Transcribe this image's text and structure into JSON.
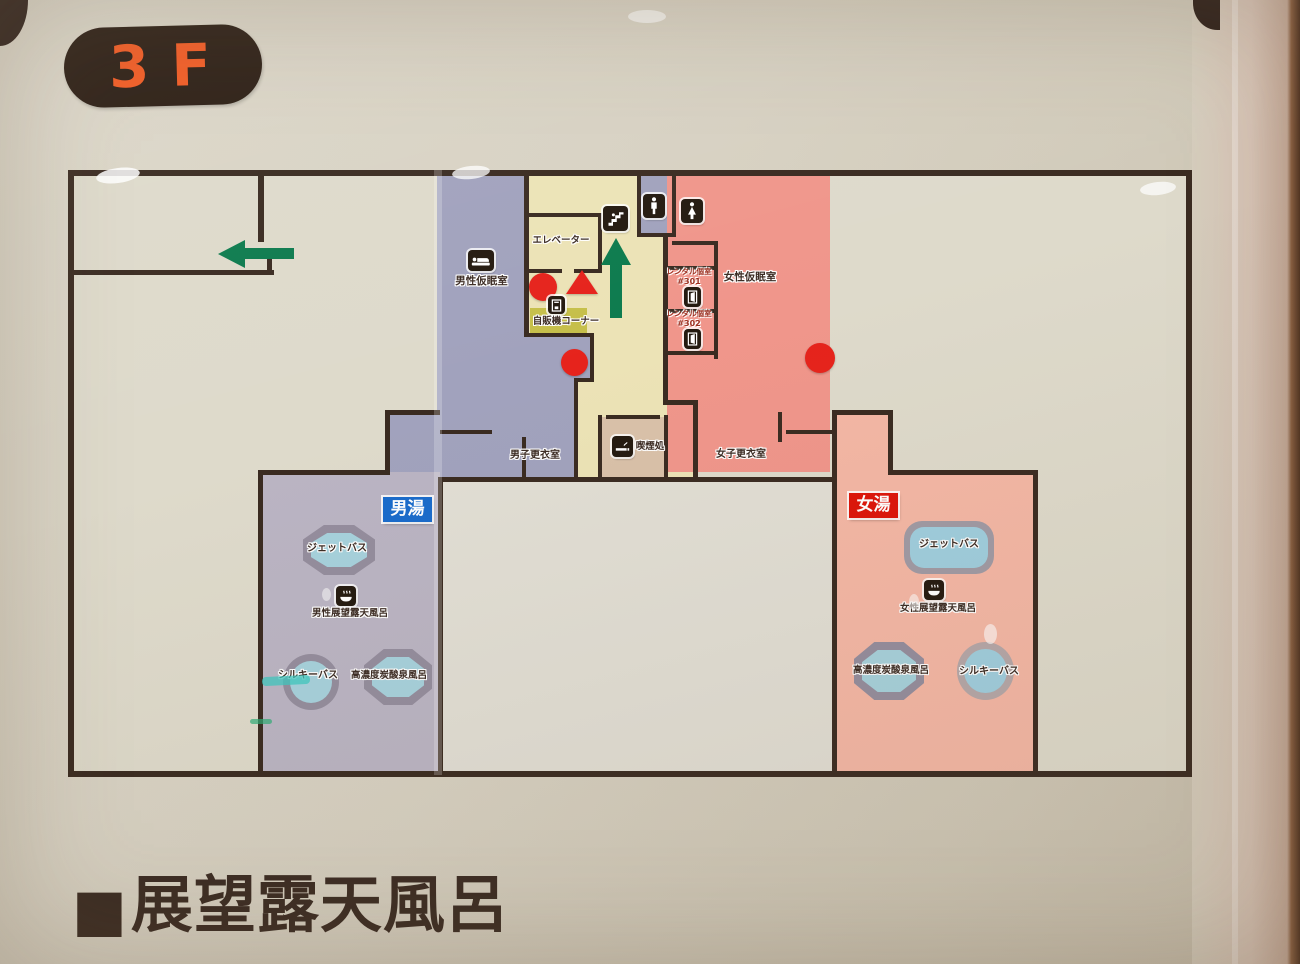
{
  "floor_badge": {
    "label": "3F"
  },
  "plan": {
    "rooms": {
      "male_nap_room": "男性仮眠室",
      "elevator": "エレベーター",
      "vending_corner": "自販機コーナー",
      "male_changing_room": "男子更衣室",
      "smoking_area": "喫煙処",
      "female_changing_room": "女子更衣室",
      "female_nap_room": "女性仮眠室",
      "rental_301": {
        "name": "レンタル個室",
        "number": "#301"
      },
      "rental_302": {
        "name": "レンタル個室",
        "number": "#302"
      }
    },
    "mens_bath": {
      "zone_label": "男湯",
      "jet_bath": "ジェットバス",
      "observation_bath": "男性展望露天風呂",
      "silky_bath": "シルキーバス",
      "carbonated_bath": "高濃度炭酸泉風呂"
    },
    "womens_bath": {
      "zone_label": "女湯",
      "jet_bath": "ジェットバス",
      "observation_bath": "女性展望露天風呂",
      "silky_bath": "シルキーバス",
      "carbonated_bath": "高濃度炭酸泉風呂"
    }
  },
  "legend": {
    "bullet": "■",
    "title": "展望露天風呂"
  },
  "icons": {
    "bed": "nap-room bed pictogram",
    "stairs": "stairs pictogram",
    "male_toilet": "men's restroom pictogram",
    "female_toilet": "women's restroom pictogram",
    "vending_machine": "vending machine pictogram",
    "smoking": "smoking area pictogram",
    "door": "private room door pictogram",
    "onsen_bath": "open-air bath pictogram",
    "up_arrow": "green route arrow up",
    "left_arrow": "green route arrow left",
    "red_circle": "current location / route marker",
    "red_triangle": "route marker"
  },
  "colors": {
    "wall": "#3a2b21",
    "zone_purple": "#a1a2bd",
    "zone_mens_bath": "#bab4c3",
    "zone_yellow": "#ece3b6",
    "zone_pink": "#f0968b",
    "zone_womens_bath": "#f4b7a5",
    "smoking_room": "#d9c1a9",
    "vending_block": "#c6bf4a",
    "bath_water": "#a6d1dc",
    "bath_rim": "#948d9d",
    "arrow_green": "#0d7b4e",
    "marker_red": "#e6231c",
    "mens_tag_blue": "#1a6bcb",
    "womens_tag_red": "#dd1509",
    "badge_bg": "#2b1d13",
    "badge_text": "#f15a22"
  }
}
